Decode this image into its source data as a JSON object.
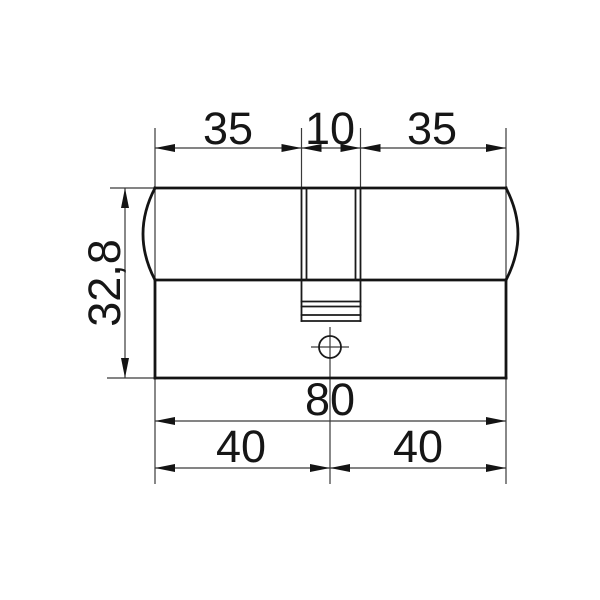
{
  "drawing": {
    "name": "lock-cylinder-dimension-drawing",
    "type": "technical-drawing",
    "dims": {
      "top_left_width": "35",
      "top_center_width": "10",
      "top_right_width": "35",
      "body_height": "32,8",
      "total_length": "80",
      "bottom_left_length": "40",
      "bottom_right_length": "40"
    },
    "colors": {
      "background": "#ffffff",
      "line": "#141414",
      "thin_line": "#3a3a3a",
      "text": "#161616"
    }
  }
}
